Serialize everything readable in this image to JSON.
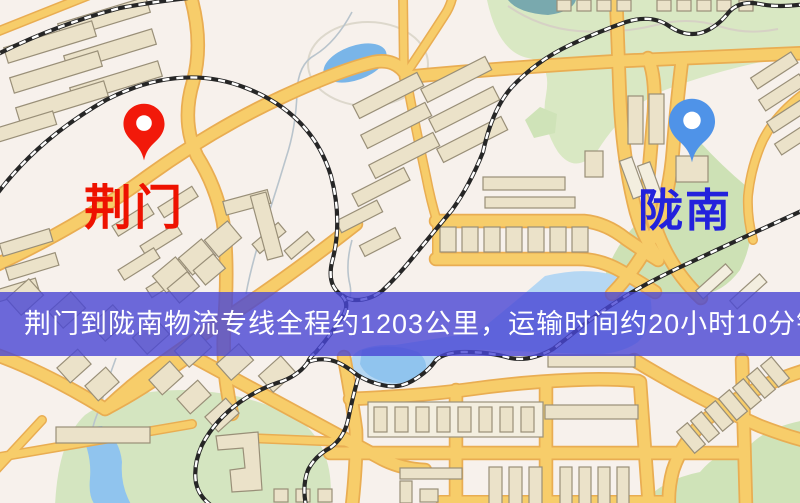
{
  "map": {
    "origin_marker": {
      "label": "荆门",
      "pin_color": "#f2190a",
      "label_color": "#ee1200"
    },
    "destination_marker": {
      "label": "陇南",
      "pin_color": "#4f93e8",
      "label_color": "#2322dc"
    },
    "colors": {
      "background": "#f7f1ec",
      "road": "#f7cd6a",
      "road_casing": "#e9ad52",
      "building": "#ebe2c9",
      "park": "#d9e8c3",
      "water": "#90c4ee",
      "railway": "#262626"
    }
  },
  "banner": {
    "text": "荆门到陇南物流专线全程约1203公里，运输时间约20小时10分钟.",
    "distance_text": "约1203公里",
    "duration_text": "约20小时10分钟",
    "background": "rgba(72,70,212,0.8)",
    "text_color": "#ffffff"
  }
}
